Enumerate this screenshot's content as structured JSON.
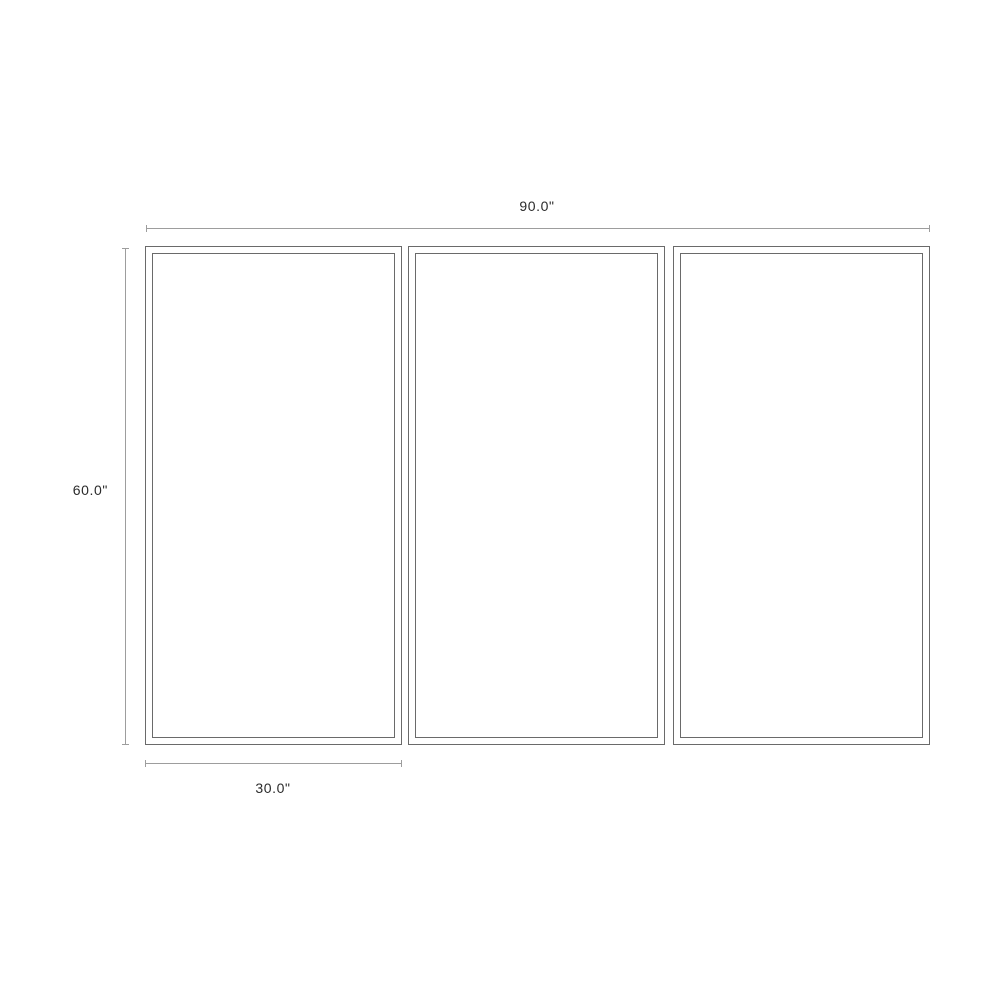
{
  "colors": {
    "background": "#ffffff",
    "panel-border": "#6a6a6a",
    "dimension-line": "#9d9d9d",
    "label-text": "#2b2b2b"
  },
  "diagram": {
    "type": "product-dimension-diagram",
    "description": "Three-panel rectangular frames shown front-on with overall and per-panel dimension callouts",
    "panel_count": 3,
    "labels": {
      "total_width": "90.0\"",
      "total_height": "60.0\"",
      "panel_width": "30.0\""
    },
    "dimensions": {
      "total_width_in": 90.0,
      "total_height_in": 60.0,
      "panel_width_in": 30.0
    }
  }
}
